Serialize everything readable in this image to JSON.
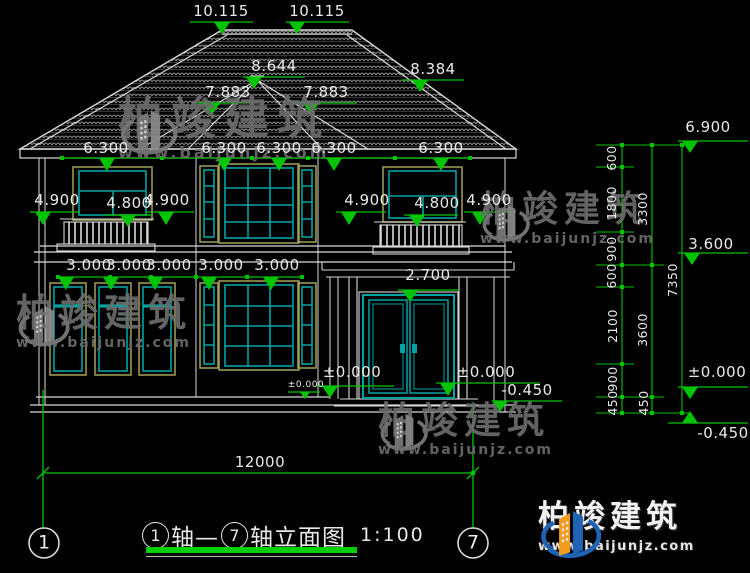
{
  "drawing_title": {
    "axis_start": "1",
    "mid": "轴—",
    "axis_end": "7",
    "suffix": "轴立面图",
    "scale": "1:100"
  },
  "axes": {
    "left": "1",
    "right": "7"
  },
  "elev": {
    "ridge_l": "10.115",
    "ridge_r": "10.115",
    "peak": "8.644",
    "turret_l": "7.883",
    "turret_r": "7.883",
    "hip": "8.384",
    "eave": [
      "6.300",
      "6.300",
      "6.300",
      "6.300",
      "6.300"
    ],
    "f2l": [
      "4.900",
      "4.800",
      "4.900"
    ],
    "f2r": [
      "4.900",
      "4.800",
      "4.900"
    ],
    "f1": [
      "3.000",
      "3.000",
      "3.000",
      "3.000",
      "3.000"
    ],
    "door": "2.700",
    "zero_c": "±0.000",
    "zero_c_sm": "±0.000",
    "zero_r": "±0.000",
    "step": "-0.450",
    "r_top": "6.900",
    "r_mid": "3.600",
    "r_zero": "±0.000",
    "r_minus": "-0.450"
  },
  "chain": {
    "inner": [
      "600",
      "1800",
      "900",
      "600",
      "2100",
      "900",
      "450"
    ],
    "mid": [
      "3300",
      "3600",
      "450"
    ],
    "outer": "7350",
    "total": "12000"
  },
  "watermark": {
    "name": "柏竣建筑",
    "url": "www.baijunjz.com"
  },
  "colors": {
    "green": "#00c400",
    "teal": "#00a3a3",
    "tan": "#a3a356",
    "line": "#d9d9d9",
    "logo_blue": "#1f63b5",
    "logo_orange": "#f29b1d",
    "wm_gray": "#6c6c6c"
  }
}
